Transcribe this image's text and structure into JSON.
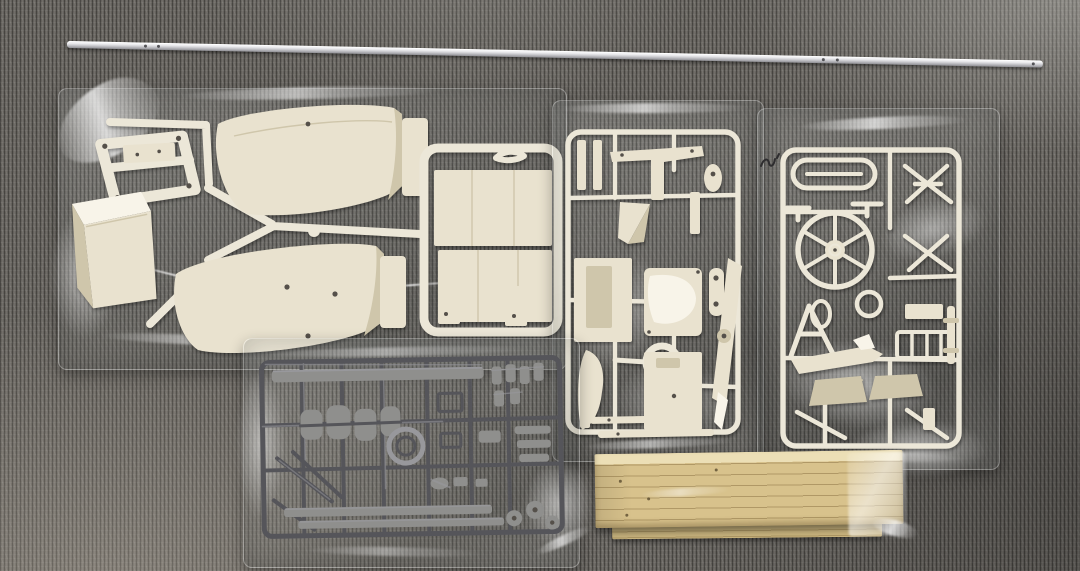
{
  "meta": {
    "title": "Model kit box contents laid out on gray carpet",
    "description": "Top-down photo of an unassembled hobby model kit: one long aluminum tube, three clear bags of white/cream plastic sprue parts, one clear bag with a dark gray sprue, and a plastic-wrapped bundle of wood strips, all arranged on dark ribbed gray carpet."
  },
  "palette": {
    "carpet_base": "#64615c",
    "carpet_dark": "#3f3d3a",
    "carpet_light": "#8f8a84",
    "sprue_white": "#ece7d8",
    "sprue_bright": "#f8f4e9",
    "part_cream": "#e9e2cf",
    "cream_shadow": "#cfc6ab",
    "cream_dark": "#b5ab8d",
    "dark_sprue": "#404043",
    "dark_sprue_mid": "#55555a",
    "dark_sprue_hi": "#98989c",
    "dark_sprue_blob": "#8f8f8d",
    "wood": "#d8c28c",
    "wood_light": "#ecdfb6",
    "wood_dim": "#c9b47e",
    "wood_dark": "#a8905f",
    "rod_light": "#f0f0f2",
    "rod_mid": "#cfcfd3",
    "rod_dark": "#8f8f94"
  },
  "objects": {
    "carpet": {
      "title": "Dark gray ribbed carpet background"
    },
    "rod": {
      "title": "Long silver aluminum tube with small pre-drilled holes",
      "hole_count": 5
    },
    "bag_a": {
      "title": "Clear bag: large cream hull/float panels, chassis frame, open box part, and deck-panel sprue",
      "part_summary": [
        "two large curved hull panels",
        "motor-mount chassis frame",
        "open rectangular box",
        "framed sprue of flat deck panels",
        "Y-shaped runner"
      ]
    },
    "bag_b": {
      "title": "Clear bag: white sprue B with tailplane, wedge, seat, plates, ring and long strut arm",
      "part_summary": [
        "T tailplane",
        "triangular wedge",
        "teardrop link",
        "panel plates",
        "bucket seat",
        "circular ring",
        "long tapered arm",
        "two long tie bars"
      ]
    },
    "bag_c": {
      "title": "Clear bag: white sprue C with elongated loop, large spoked wheel, small ring, ladder frame and two pans",
      "part_summary": [
        "elongated oval loop",
        "six-spoke wheel",
        "small ring",
        "A-frame strut",
        "tapered float",
        "ladder frame",
        "mast post",
        "two trapezoid pans"
      ],
      "wheel_spokes": 6
    },
    "bag_d": {
      "title": "Clear bag: dense dark-gray detail sprue with long rails, round ring and many small fittings"
    },
    "wood": {
      "title": "Plastic-wrapped bundle of light wood strips",
      "strip_lines": 6
    },
    "thread": {
      "title": "Small dark carpet fiber squiggle"
    }
  }
}
